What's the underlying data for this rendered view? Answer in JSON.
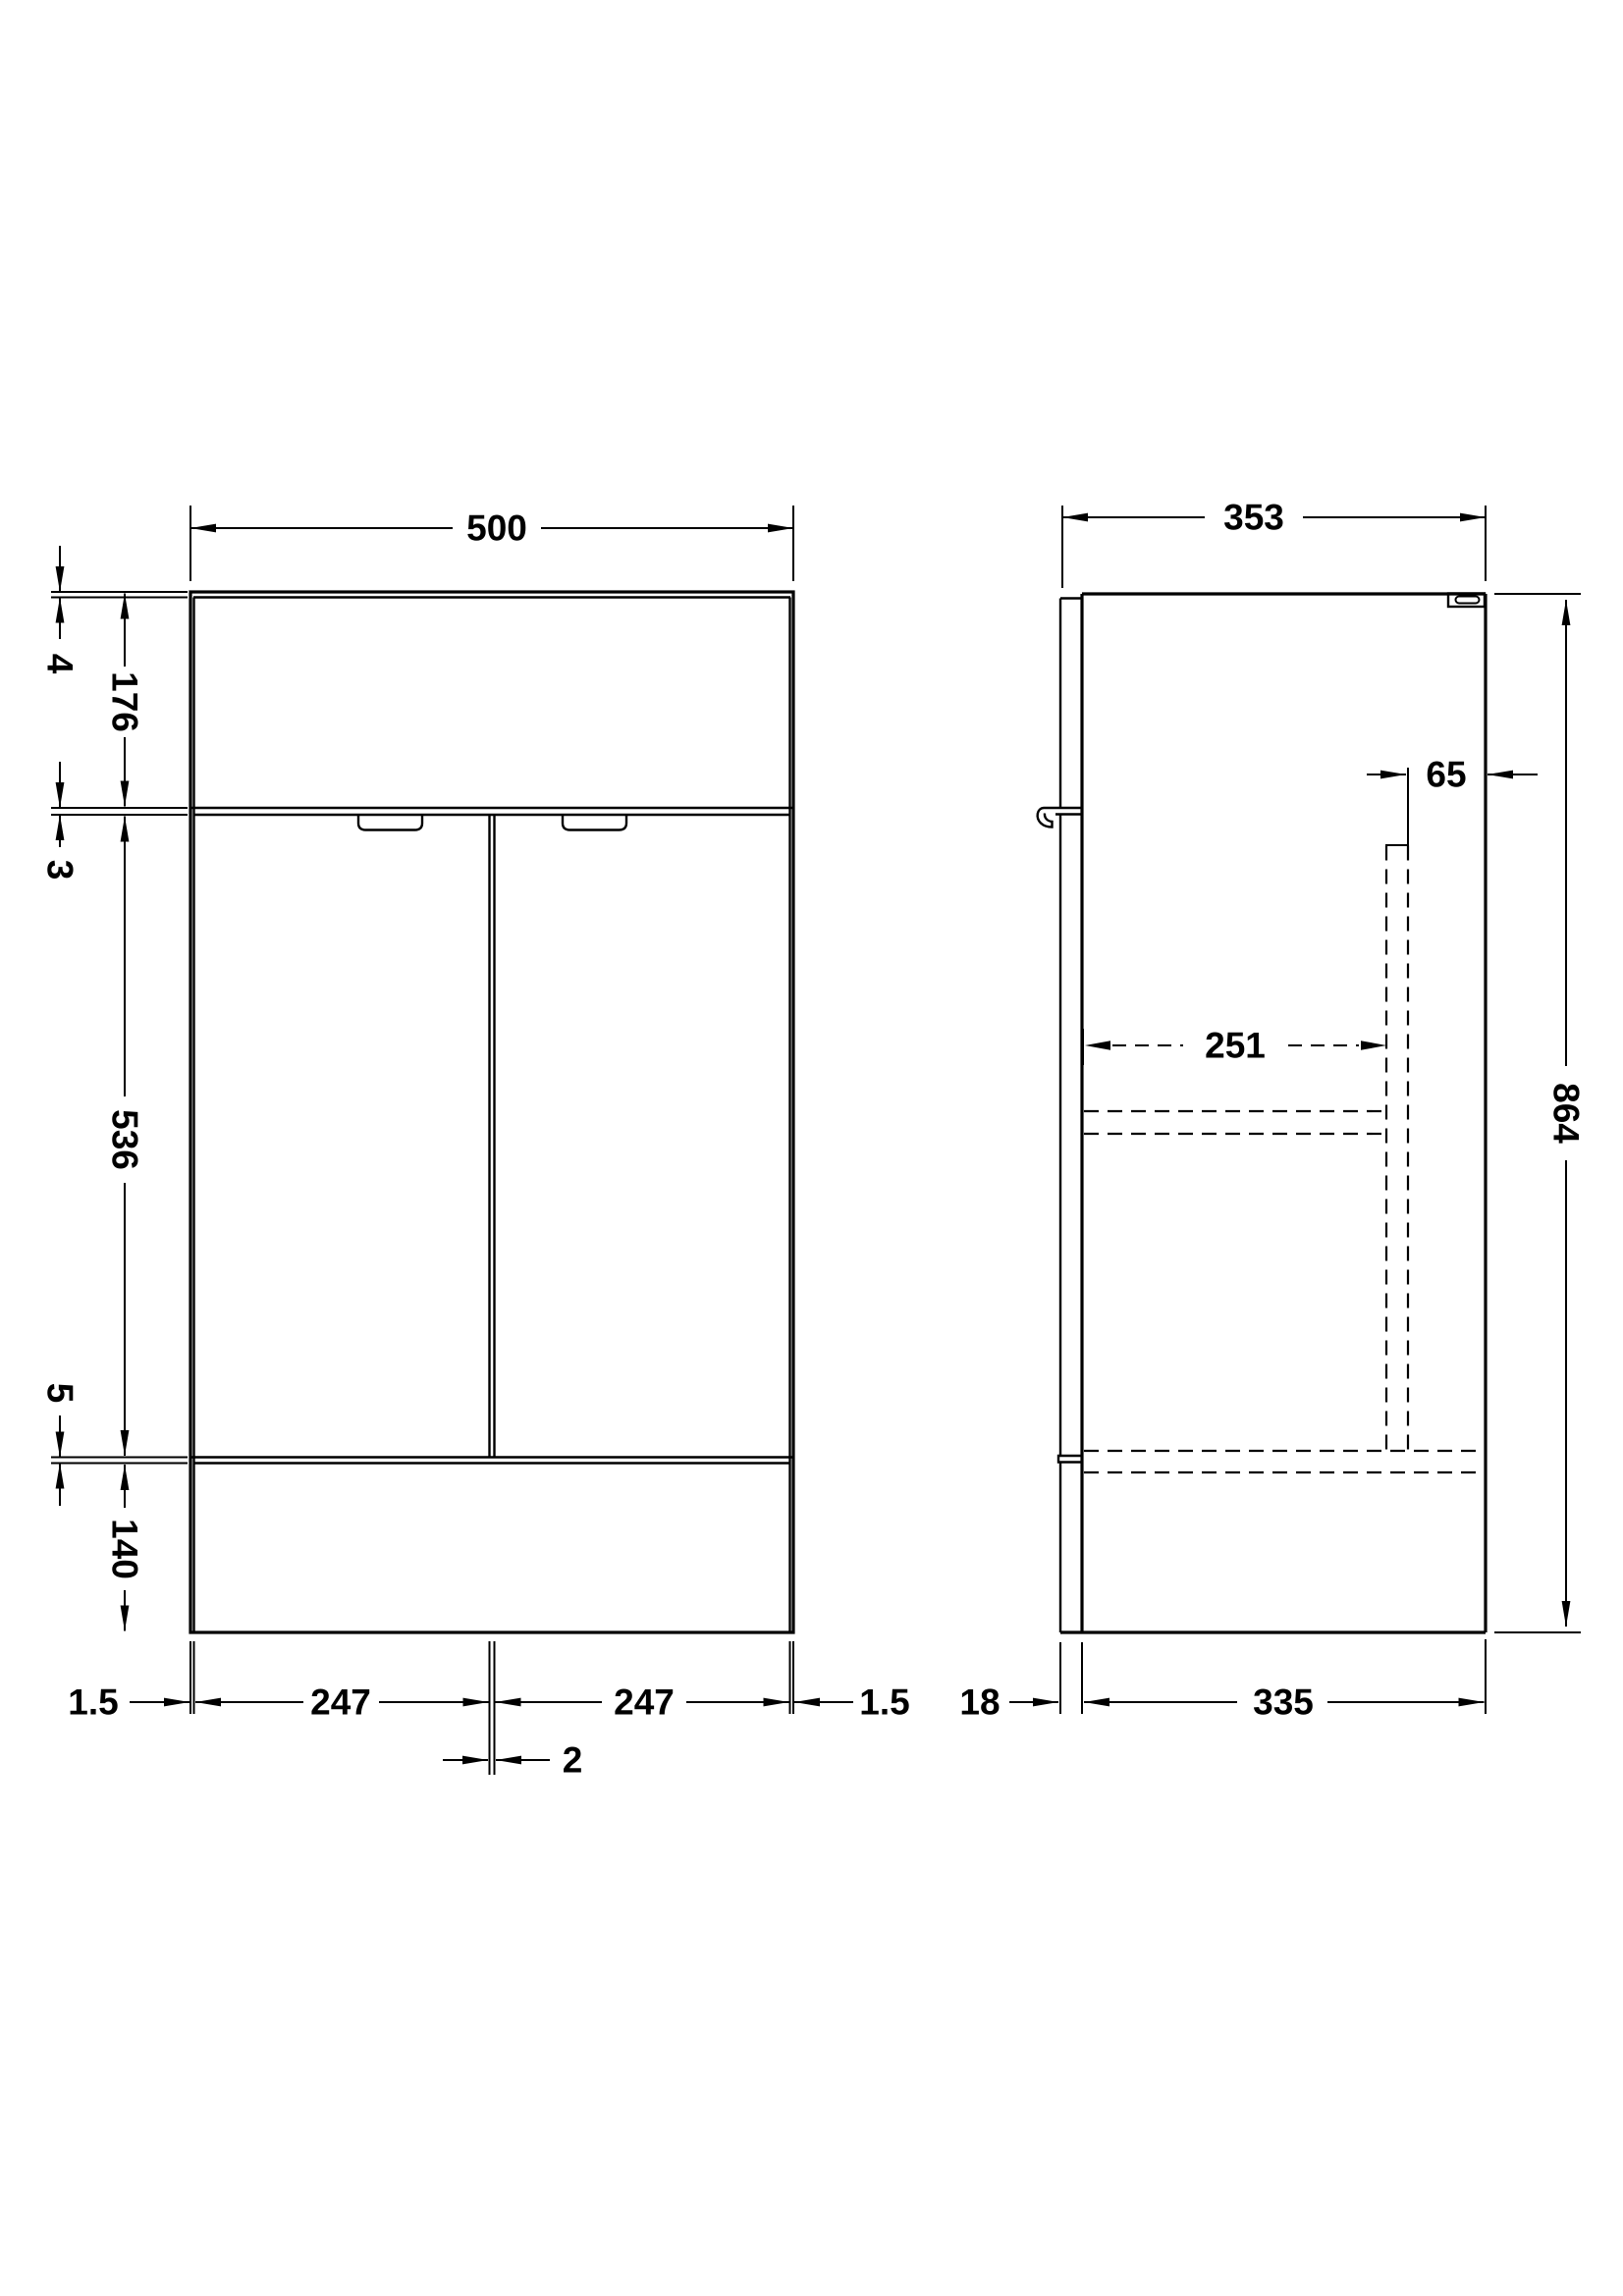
{
  "colors": {
    "line": "#000000",
    "background": "#ffffff"
  },
  "front_view": {
    "overall_width": "500",
    "worktop_thickness": "4",
    "upper_panel_height": "176",
    "door_top_gap": "3",
    "door_height": "536",
    "door_bottom_gap": "5",
    "plinth_height": "140",
    "left_edge_gap": "1.5",
    "left_door_width": "247",
    "door_center_gap": "2",
    "right_door_width": "247",
    "right_edge_gap": "1.5"
  },
  "side_view": {
    "overall_depth": "353",
    "back_clearance": "65",
    "internal_depth": "251",
    "overall_height": "864",
    "plinth_recess": "18",
    "body_depth": "335"
  }
}
